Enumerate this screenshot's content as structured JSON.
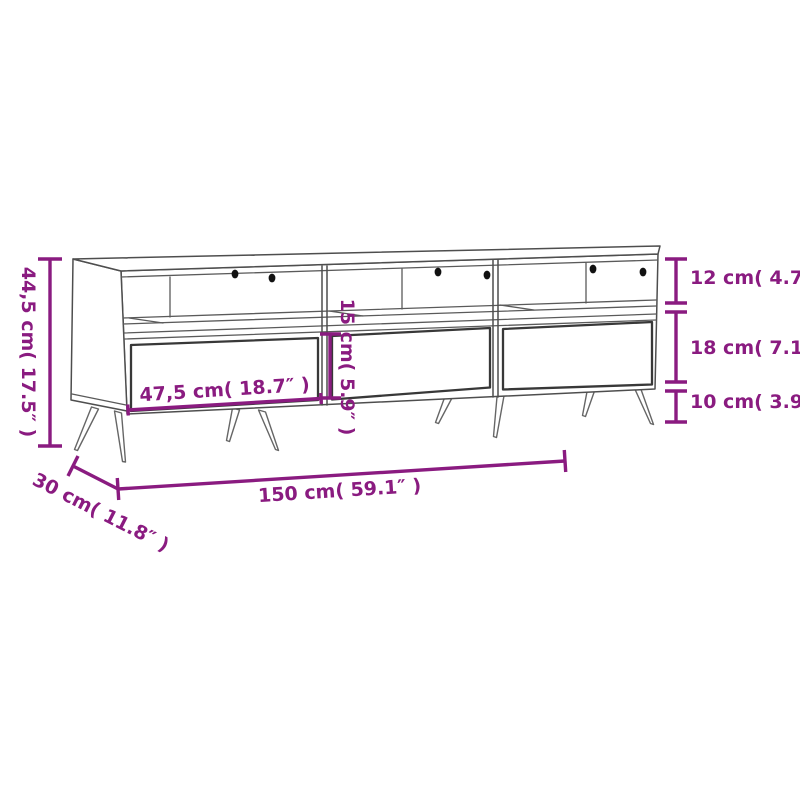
{
  "diagram": {
    "title": "tv-cabinet-dimension-diagram",
    "accent_color": "#8a1b80",
    "line_color": "#4e4e4e",
    "background": "#ffffff",
    "labels": {
      "overall_height": "44,5 cm( 17.5″ )",
      "overall_width": "150 cm( 59.1″ )",
      "overall_depth": "30 cm( 11.8″ )",
      "compartment_height": "12 cm( 4.7″ )",
      "drawer_front_height_right": "18 cm( 7.1″ )",
      "leg_height": "10 cm( 3.9″ )",
      "drawer_width": "47,5 cm( 18.7″ )",
      "drawer_front_height_middle": "15 cm( 5.9″ )"
    }
  }
}
